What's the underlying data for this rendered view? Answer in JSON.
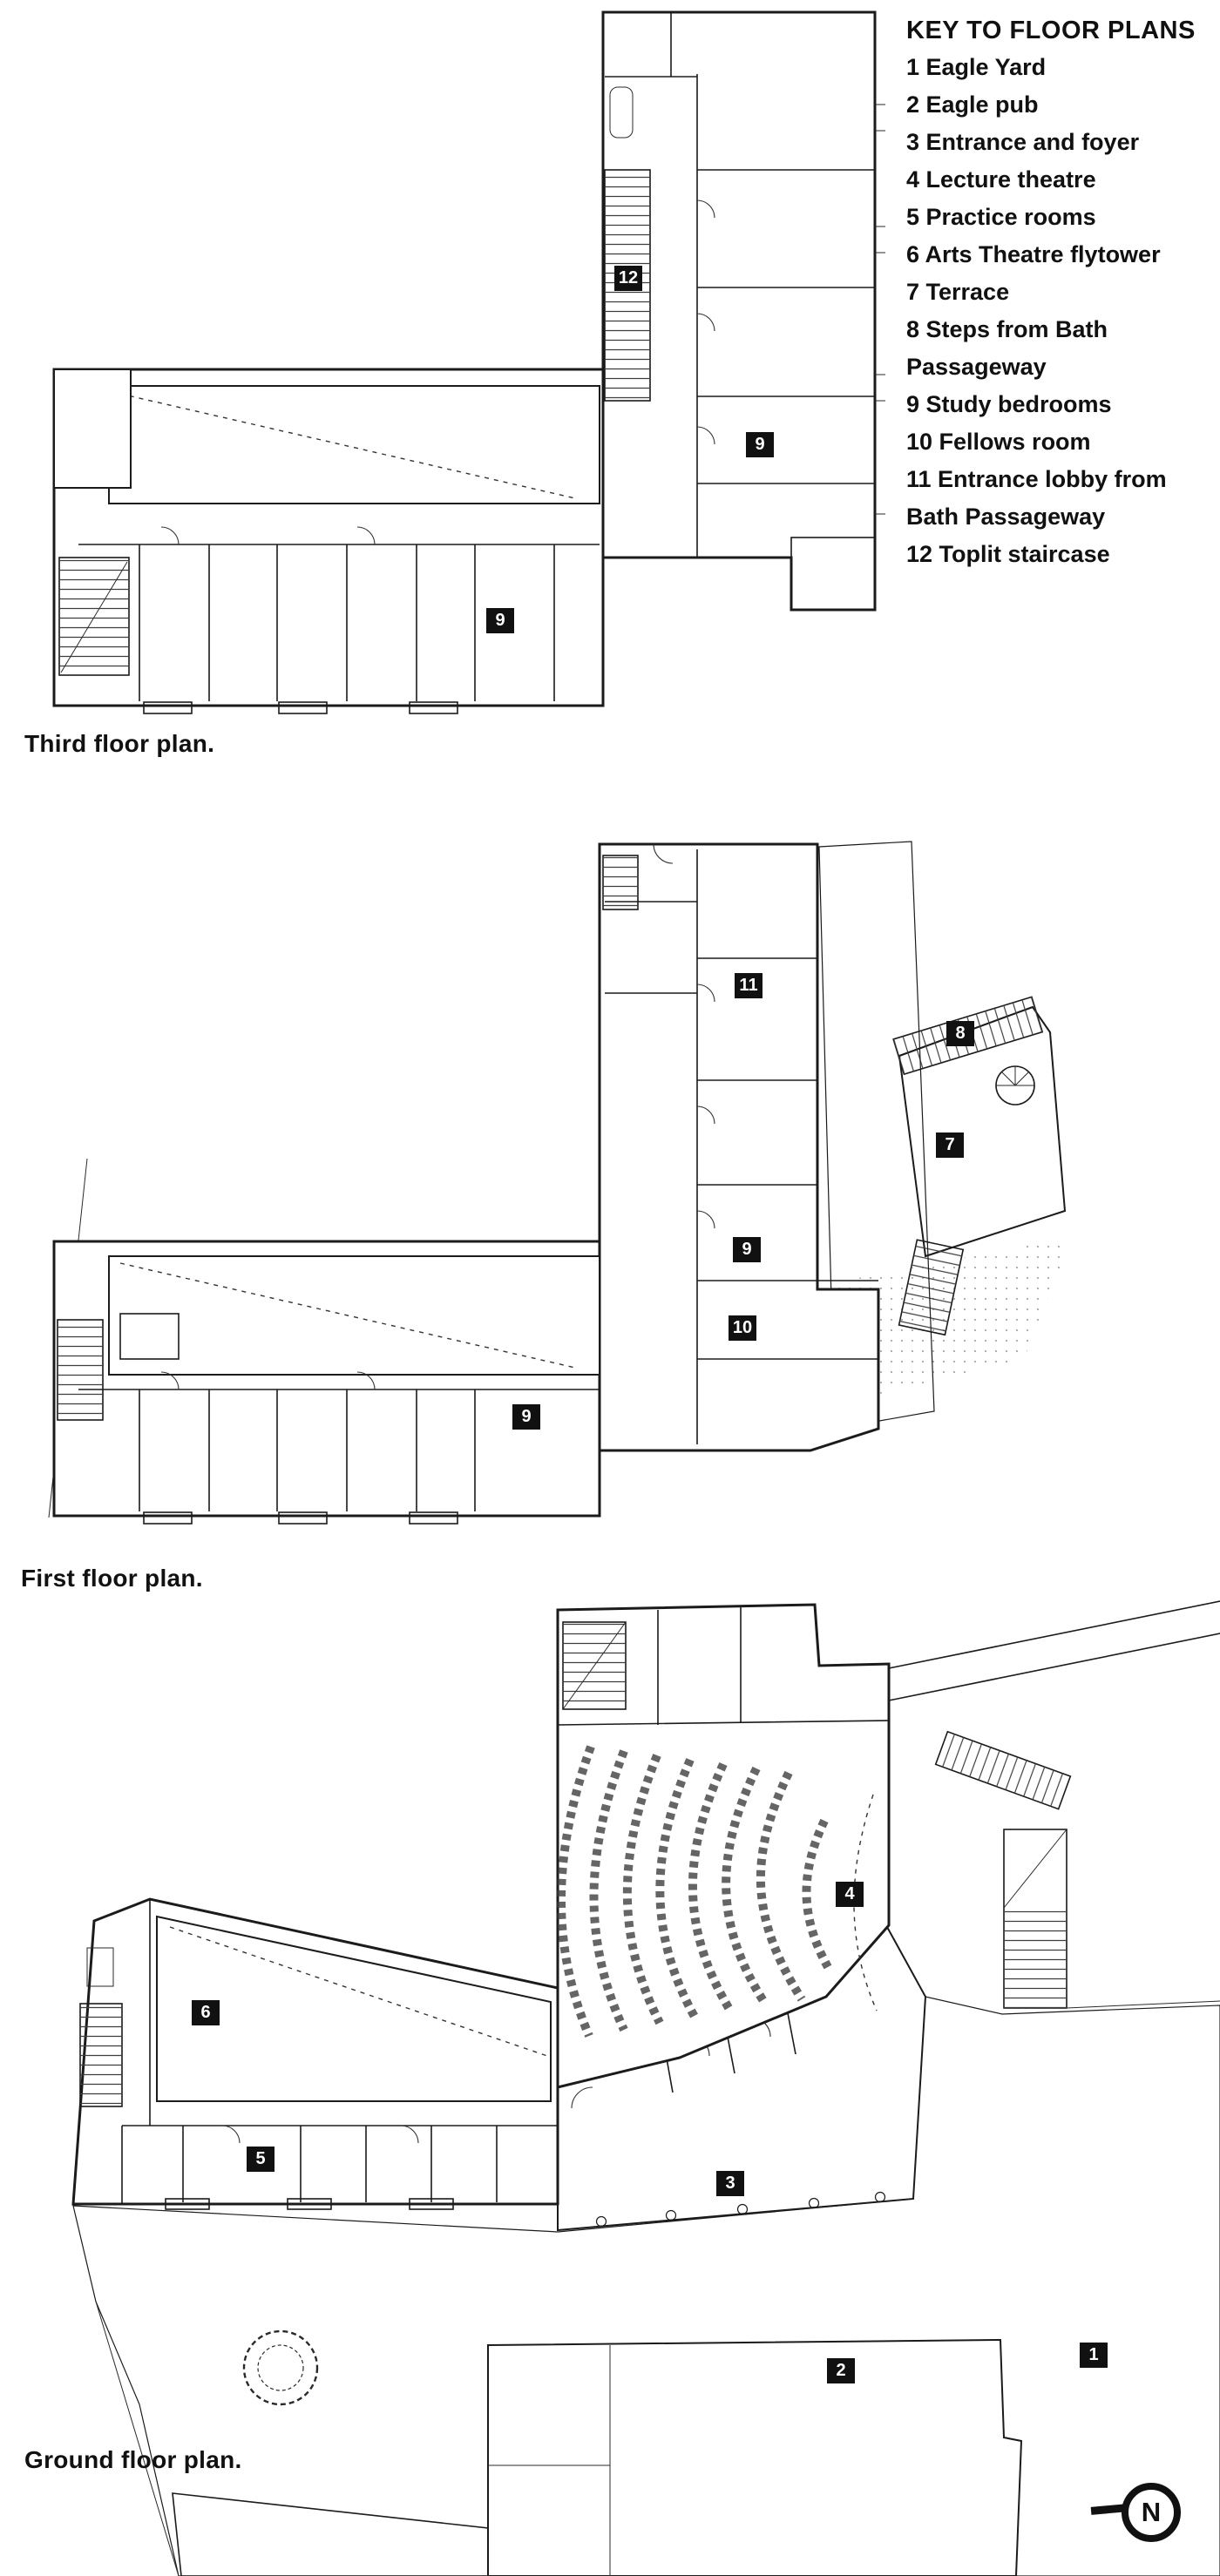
{
  "key": {
    "title": "KEY TO FLOOR PLANS",
    "items": [
      "1 Eagle Yard",
      "2 Eagle pub",
      "3 Entrance and foyer",
      "4 Lecture theatre",
      "5 Practice rooms",
      "6 Arts Theatre flytower",
      "7 Terrace",
      "8 Steps from Bath Passageway",
      "9 Study bedrooms",
      "10 Fellows room",
      "11 Entrance lobby from Bath Passageway",
      "12 Toplit staircase"
    ]
  },
  "plans": {
    "third": {
      "title": "Third floor plan.",
      "labels": [
        "12",
        "9",
        "9"
      ]
    },
    "first": {
      "title": "First floor plan.",
      "labels": [
        "11",
        "8",
        "7",
        "9",
        "10",
        "9"
      ]
    },
    "ground": {
      "title": "Ground floor plan.",
      "labels": [
        "6",
        "5",
        "4",
        "3",
        "2",
        "1"
      ]
    }
  },
  "north_arrow": {
    "label": "N"
  },
  "colors": {
    "ink": "#1b1b1b",
    "paper": "#ffffff",
    "label_bg": "#111111",
    "label_fg": "#ffffff"
  }
}
